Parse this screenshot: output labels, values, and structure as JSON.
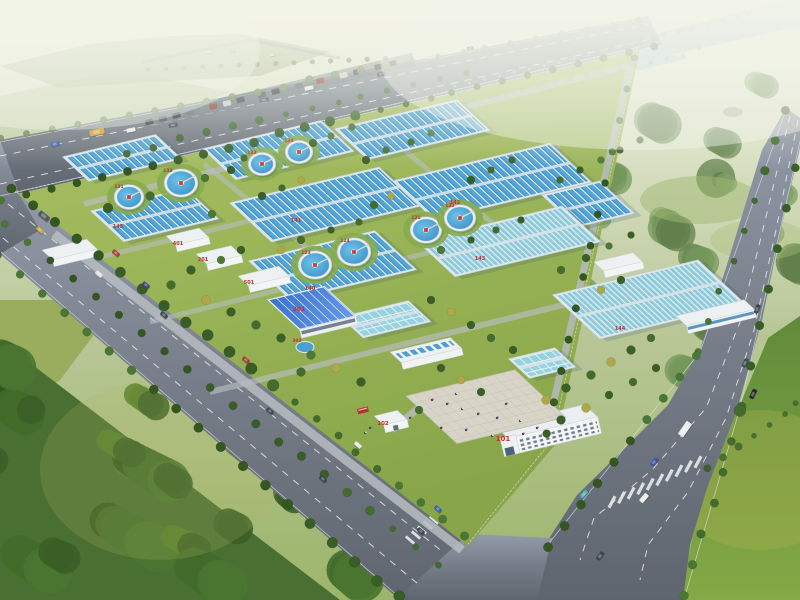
{
  "scene": {
    "description": "Aerial bird's-eye architectural rendering of a water treatment plant campus: rows of rectangular blue treatment basins, eight circular clarifier tanks, a blue-roofed workshop, white office and auxiliary buildings, an entrance plaza and gatehouse, tree-lined boulevards meeting at a crosswalk intersection, surrounded by farmland, forest and a hazy river."
  },
  "labels": {
    "buildings": [
      {
        "id": "office-building",
        "text": "101",
        "x": 503,
        "y": 441,
        "size": 7
      },
      {
        "id": "gatehouse",
        "text": "102",
        "x": 383,
        "y": 425,
        "size": 5.5
      },
      {
        "id": "dosing-building",
        "text": "201",
        "x": 203,
        "y": 261,
        "size": 5
      },
      {
        "id": "workshop-building",
        "text": "301",
        "x": 299,
        "y": 311,
        "size": 6
      },
      {
        "id": "storage-tank",
        "text": "302",
        "x": 297,
        "y": 342,
        "size": 4.5
      },
      {
        "id": "substation",
        "text": "401",
        "x": 178,
        "y": 245,
        "size": 5
      },
      {
        "id": "blower-building",
        "text": "501",
        "x": 249,
        "y": 284,
        "size": 5
      }
    ],
    "basins": [
      {
        "id": "basin-b8",
        "text": "140",
        "x": 310,
        "y": 290,
        "size": 5
      },
      {
        "id": "basin-b4",
        "text": "141",
        "x": 296,
        "y": 222,
        "size": 5
      },
      {
        "id": "basin-b6",
        "text": "142",
        "x": 455,
        "y": 204,
        "size": 5
      },
      {
        "id": "basin-b7",
        "text": "143",
        "x": 480,
        "y": 260,
        "size": 5
      },
      {
        "id": "basin-b9",
        "text": "144",
        "x": 620,
        "y": 330,
        "size": 5
      },
      {
        "id": "basin-b2",
        "text": "145",
        "x": 118,
        "y": 228,
        "size": 5
      }
    ],
    "clarifiers": [
      {
        "id": "clarifier-1",
        "text": "131",
        "x": 119,
        "y": 188,
        "size": 4.5
      },
      {
        "id": "clarifier-2",
        "text": "132",
        "x": 168,
        "y": 172,
        "size": 4.5
      },
      {
        "id": "clarifier-3",
        "text": "133",
        "x": 252,
        "y": 154,
        "size": 4.5
      },
      {
        "id": "clarifier-4",
        "text": "134",
        "x": 289,
        "y": 142,
        "size": 4.5
      },
      {
        "id": "clarifier-5",
        "text": "121",
        "x": 416,
        "y": 219,
        "size": 4.5
      },
      {
        "id": "clarifier-6",
        "text": "122",
        "x": 450,
        "y": 207,
        "size": 4.5
      },
      {
        "id": "clarifier-7",
        "text": "123",
        "x": 306,
        "y": 254,
        "size": 4.5
      },
      {
        "id": "clarifier-8",
        "text": "124",
        "x": 345,
        "y": 242,
        "size": 4.5
      }
    ]
  },
  "colors": {
    "label_red": "#c41f1f",
    "pool_blue": "#3e9ad2",
    "pool_lane_white": "#dceef8",
    "clear_pool": "#93cfe0",
    "tank_water": "#2f8cc6",
    "roof_blue": "#2f6cd4",
    "building_white": "#f3f5f7",
    "road_gray": "#646c78",
    "grass_green": "#8fae46",
    "tree_green": "#2f5c1d",
    "autumn_yellow": "#c2a844",
    "river_blue": "#a9c2d6",
    "plaza_tan": "#d6d3c6"
  }
}
